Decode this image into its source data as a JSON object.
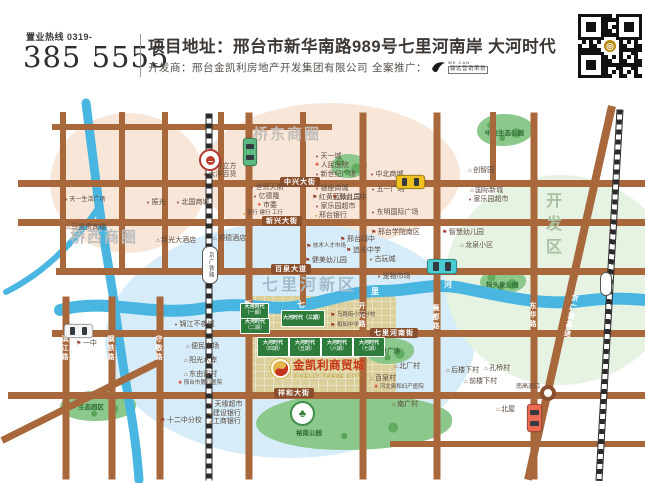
{
  "header": {
    "hotline_label": "置业热线 0319-",
    "phone": "385 5555",
    "address": "项目地址：邢台市新华南路989号七里河南岸 大河时代",
    "developer": "开发商：邢台金凯利房地产开发集团有限公司",
    "promo_label": "全案推广：",
    "promo_brand_line1": "WE CAN",
    "promo_brand_line2": "骏远营销策划"
  },
  "project": {
    "logo_title": "金凯利商贸城",
    "logo_sub": "J-KELLY TRADE CITY",
    "brand_color": "#c63420",
    "gold_color": "#c09a27",
    "area": {
      "x": 246,
      "y": 296,
      "w": 150,
      "h": 97
    },
    "logo_circle": {
      "x": 270,
      "y": 358,
      "d": 21
    },
    "title_pos": {
      "x": 293,
      "y": 361
    },
    "sub_pos": {
      "x": 294,
      "y": 375
    }
  },
  "map": {
    "zones": [
      {
        "name": "qiaoxi-circle",
        "x": 50,
        "y": 113,
        "w": 156,
        "h": 140,
        "color": "#f8e7d8"
      },
      {
        "name": "qiaodong-circle",
        "x": 200,
        "y": 103,
        "w": 260,
        "h": 144,
        "color": "#f8e7d8"
      },
      {
        "name": "qilihe-circle",
        "x": 105,
        "y": 222,
        "w": 370,
        "h": 236,
        "color": "#d6ecf8"
      },
      {
        "name": "kaifaqu-circle",
        "x": 445,
        "y": 175,
        "w": 230,
        "h": 210,
        "color": "#e6f3e2"
      }
    ],
    "zone_labels": [
      {
        "text": "桥西商圈",
        "x": 70,
        "y": 230,
        "size": 15,
        "color": "#bdbdbd",
        "ls": 2
      },
      {
        "text": "桥东商圈",
        "x": 253,
        "y": 127,
        "size": 15,
        "color": "#c4beb8",
        "ls": 2
      },
      {
        "text": "七里河新区",
        "x": 262,
        "y": 278,
        "size": 16,
        "color": "#a3bccb",
        "ls": 3
      },
      {
        "text": "开发区",
        "x": 543,
        "y": 192,
        "size": 16,
        "color": "#a9bfa0",
        "ls": 7,
        "vertical": true
      }
    ],
    "rivers": [
      {
        "d": "M 86 103 C 92 150 95 175 99 205 C 103 235 108 262 113 295 C 118 330 121 355 128 395 C 133 425 137 450 139 480",
        "w": 9
      },
      {
        "d": "M 99 207 C 82 232 58 258 34 275 C 24 282 14 288 6 292",
        "w": 6
      },
      {
        "d": "M 60 310 C 110 297 150 318 205 308 C 245 300 268 312 300 306 C 332 300 352 291 382 291 C 412 291 432 282 462 288 C 502 296 542 306 582 301 C 612 297 632 299 645 300",
        "w": 12
      }
    ],
    "river_color": "#49b6e2",
    "river_chars": [
      {
        "text": "七",
        "x": 297,
        "y": 301
      },
      {
        "text": "里",
        "x": 371,
        "y": 288
      },
      {
        "text": "河",
        "x": 444,
        "y": 281
      }
    ],
    "roads": [
      {
        "x1": 52,
        "y1": 127,
        "x2": 332,
        "y2": 127,
        "w": 6
      },
      {
        "x1": 18,
        "y1": 183,
        "x2": 645,
        "y2": 183,
        "w": 7
      },
      {
        "x1": 18,
        "y1": 222,
        "x2": 645,
        "y2": 222,
        "w": 7
      },
      {
        "x1": 56,
        "y1": 271,
        "x2": 645,
        "y2": 271,
        "w": 7
      },
      {
        "x1": 52,
        "y1": 333,
        "x2": 645,
        "y2": 333,
        "w": 7
      },
      {
        "x1": 8,
        "y1": 395,
        "x2": 645,
        "y2": 395,
        "w": 7
      },
      {
        "x1": 390,
        "y1": 444,
        "x2": 645,
        "y2": 444,
        "w": 6
      },
      {
        "x1": 63,
        "y1": 112,
        "x2": 63,
        "y2": 273,
        "w": 6
      },
      {
        "x1": 122,
        "y1": 112,
        "x2": 122,
        "y2": 273,
        "w": 6
      },
      {
        "x1": 165,
        "y1": 112,
        "x2": 165,
        "y2": 273,
        "w": 6
      },
      {
        "x1": 221,
        "y1": 112,
        "x2": 221,
        "y2": 273,
        "w": 6
      },
      {
        "x1": 66,
        "y1": 296,
        "x2": 66,
        "y2": 479,
        "w": 7
      },
      {
        "x1": 112,
        "y1": 296,
        "x2": 112,
        "y2": 479,
        "w": 7
      },
      {
        "x1": 160,
        "y1": 296,
        "x2": 160,
        "y2": 479,
        "w": 7
      },
      {
        "x1": 249,
        "y1": 112,
        "x2": 249,
        "y2": 479,
        "w": 7
      },
      {
        "x1": 303,
        "y1": 112,
        "x2": 303,
        "y2": 305,
        "w": 6
      },
      {
        "x1": 363,
        "y1": 112,
        "x2": 363,
        "y2": 479,
        "w": 7
      },
      {
        "x1": 437,
        "y1": 112,
        "x2": 437,
        "y2": 479,
        "w": 7
      },
      {
        "x1": 493,
        "y1": 112,
        "x2": 493,
        "y2": 186,
        "w": 6
      },
      {
        "x1": 534,
        "y1": 112,
        "x2": 534,
        "y2": 479,
        "w": 7
      },
      {
        "x1": 612,
        "y1": 106,
        "x2": 528,
        "y2": 480,
        "w": 8
      },
      {
        "x1": 2,
        "y1": 440,
        "x2": 162,
        "y2": 360,
        "w": 7
      }
    ],
    "railways": [
      {
        "x1": 209,
        "y1": 112,
        "x2": 209,
        "y2": 479,
        "w": 5
      },
      {
        "x1": 620,
        "y1": 108,
        "x2": 599,
        "y2": 479,
        "w": 5
      }
    ],
    "banners": [
      {
        "text": "中兴大街",
        "x": 280,
        "y": 177
      },
      {
        "text": "新兴大街",
        "x": 262,
        "y": 216
      },
      {
        "text": "百泉大道",
        "x": 271,
        "y": 264
      },
      {
        "text": "七里河南街",
        "x": 370,
        "y": 328
      },
      {
        "text": "祥和大街",
        "x": 274,
        "y": 388
      }
    ],
    "vlabels": [
      {
        "text": "新华路",
        "x": 244,
        "y": 300
      },
      {
        "text": "开元路",
        "x": 358,
        "y": 302
      },
      {
        "text": "襄都路",
        "x": 432,
        "y": 304
      },
      {
        "text": "东华路",
        "x": 529,
        "y": 302
      },
      {
        "text": "滨江路",
        "x": 61,
        "y": 335
      },
      {
        "text": "钢铁路",
        "x": 107,
        "y": 335
      },
      {
        "text": "守敬路",
        "x": 155,
        "y": 335
      },
      {
        "text": "京广澳高速",
        "x": 567,
        "y": 294,
        "rot": 12
      }
    ],
    "parks": [
      {
        "x": 477,
        "y": 114,
        "w": 56,
        "h": 32,
        "label": "中央生态公园",
        "lx": 8,
        "ly": 13
      },
      {
        "x": 331,
        "y": 154,
        "w": 36,
        "h": 24,
        "label": "",
        "lx": 0,
        "ly": 0
      },
      {
        "x": 480,
        "y": 269,
        "w": 46,
        "h": 25,
        "label": "狗头泉公园",
        "lx": 6,
        "ly": 10
      },
      {
        "x": 366,
        "y": 338,
        "w": 48,
        "h": 26,
        "label": "百泉广场",
        "lx": 8,
        "ly": 7
      },
      {
        "x": 60,
        "y": 391,
        "w": 76,
        "h": 30,
        "label": "生态园区",
        "lx": 18,
        "ly": 10
      },
      {
        "x": 256,
        "y": 394,
        "w": 196,
        "h": 56,
        "label": "裕南公园",
        "lx": 40,
        "ly": 33,
        "emblem": {
          "x": 34,
          "y": 7,
          "d": 21
        }
      }
    ],
    "blocks": [
      {
        "x": 240,
        "y": 303,
        "w": 27,
        "h": 14,
        "brand": "大河时代",
        "phase": "（一期）"
      },
      {
        "x": 240,
        "y": 318,
        "w": 28,
        "h": 14,
        "brand": "大河时代",
        "phase": "（二期）"
      },
      {
        "x": 281,
        "y": 310,
        "w": 42,
        "h": 15,
        "brand": "大河时代",
        "phase": "（三期）",
        "oneline": true
      },
      {
        "x": 257,
        "y": 337,
        "w": 30,
        "h": 18,
        "brand": "大河时代",
        "phase": "（四期）"
      },
      {
        "x": 289,
        "y": 337,
        "w": 30,
        "h": 18,
        "brand": "大河时代",
        "phase": "（五期）"
      },
      {
        "x": 321,
        "y": 337,
        "w": 30,
        "h": 18,
        "brand": "大河时代",
        "phase": "（六期）"
      },
      {
        "x": 353,
        "y": 337,
        "w": 30,
        "h": 18,
        "brand": "大河时代",
        "phase": "（七期）"
      }
    ],
    "pois": [
      {
        "icon": "mall",
        "text": "壹号立方",
        "x": 203,
        "y": 163
      },
      {
        "icon": "mall",
        "text": "大洋百货",
        "x": 203,
        "y": 171
      },
      {
        "icon": "mall",
        "text": "天一生活广场",
        "x": 64,
        "y": 197,
        "size": "sm"
      },
      {
        "icon": "mall",
        "text": "振光",
        "x": 146,
        "y": 199
      },
      {
        "icon": "mall",
        "text": "北国商城",
        "x": 176,
        "y": 199
      },
      {
        "icon": "hotel",
        "text": "马凯贵宾楼",
        "x": 66,
        "y": 224
      },
      {
        "icon": "hotel",
        "text": "新光大酒店",
        "x": 156,
        "y": 237
      },
      {
        "icon": "mall",
        "text": "世贸天街",
        "x": 250,
        "y": 184
      },
      {
        "icon": "mall",
        "text": "亿德隆",
        "x": 253,
        "y": 193
      },
      {
        "icon": "gov",
        "text": "市委",
        "x": 257,
        "y": 202
      },
      {
        "icon": "bank",
        "text": "农行 建行 工行",
        "x": 243,
        "y": 211,
        "size": "xs"
      },
      {
        "icon": "hotel",
        "text": "顺德酒店",
        "x": 213,
        "y": 235
      },
      {
        "icon": "mall",
        "text": "天一城",
        "x": 315,
        "y": 153
      },
      {
        "icon": "hospital",
        "text": "人民医院",
        "x": 315,
        "y": 162
      },
      {
        "icon": "mall",
        "text": "新世纪广场",
        "x": 315,
        "y": 171
      },
      {
        "icon": "mall",
        "text": "中北商城",
        "x": 370,
        "y": 171
      },
      {
        "icon": "mall",
        "text": "银座商城",
        "x": 315,
        "y": 185
      },
      {
        "icon": "school",
        "text": "红黄蓝幼儿园",
        "x": 312,
        "y": 194
      },
      {
        "icon": "mall",
        "text": "家乐园超市",
        "x": 315,
        "y": 203
      },
      {
        "icon": "bank",
        "text": "邢台银行",
        "x": 315,
        "y": 212
      },
      {
        "icon": "school",
        "text": "邢台四中",
        "x": 340,
        "y": 236
      },
      {
        "icon": "school",
        "text": "追光中学",
        "x": 346,
        "y": 247
      },
      {
        "icon": "school",
        "text": "技术人才市场",
        "x": 306,
        "y": 244,
        "size": "xs"
      },
      {
        "icon": "school",
        "text": "健美幼儿园",
        "x": 305,
        "y": 257
      },
      {
        "icon": "village",
        "text": "创智园",
        "x": 468,
        "y": 167
      },
      {
        "icon": "mall",
        "text": "五一广场",
        "x": 371,
        "y": 186
      },
      {
        "icon": "school",
        "text": "邢台二中",
        "x": 332,
        "y": 194
      },
      {
        "icon": "village",
        "text": "国际新城",
        "x": 470,
        "y": 187
      },
      {
        "icon": "mall",
        "text": "家乐园超市",
        "x": 468,
        "y": 196
      },
      {
        "icon": "mall",
        "text": "东明国际广场",
        "x": 371,
        "y": 209
      },
      {
        "icon": "school",
        "text": "邢台学院南区",
        "x": 371,
        "y": 229
      },
      {
        "icon": "school",
        "text": "智慧幼儿园",
        "x": 442,
        "y": 229
      },
      {
        "icon": "village",
        "text": "龙泉小区",
        "x": 460,
        "y": 242
      },
      {
        "icon": "mall",
        "text": "古玩城",
        "x": 369,
        "y": 256
      },
      {
        "icon": "mall",
        "text": "宠物市场",
        "x": 377,
        "y": 273
      },
      {
        "icon": "school",
        "text": "马路街小学分校",
        "x": 330,
        "y": 313,
        "size": "xs"
      },
      {
        "icon": "school",
        "text": "相如中学",
        "x": 330,
        "y": 323,
        "size": "xs"
      },
      {
        "icon": "mall",
        "text": "锦江不夜城",
        "x": 174,
        "y": 321
      },
      {
        "icon": "village",
        "text": "便民市场",
        "x": 186,
        "y": 343
      },
      {
        "icon": "village",
        "text": "阳光水岸",
        "x": 184,
        "y": 357
      },
      {
        "icon": "village",
        "text": "东由留村",
        "x": 184,
        "y": 371
      },
      {
        "icon": "hospital",
        "text": "邢台市第四医院",
        "x": 178,
        "y": 381,
        "size": "xs"
      },
      {
        "icon": "mall",
        "text": "天缘超市",
        "x": 209,
        "y": 401
      },
      {
        "icon": "bank",
        "text": "建设银行",
        "x": 209,
        "y": 410
      },
      {
        "icon": "bank",
        "text": "工商银行",
        "x": 209,
        "y": 418
      },
      {
        "icon": "school",
        "text": "十二中分校",
        "x": 160,
        "y": 417
      },
      {
        "icon": "school",
        "text": "一中",
        "x": 76,
        "y": 340
      },
      {
        "icon": "village",
        "text": "北厂村",
        "x": 394,
        "y": 363
      },
      {
        "icon": "village",
        "text": "百泉村",
        "x": 370,
        "y": 375
      },
      {
        "icon": "hospital",
        "text": "河北奥和妇产医院",
        "x": 374,
        "y": 385,
        "size": "xs"
      },
      {
        "icon": "village",
        "text": "南广村",
        "x": 392,
        "y": 401
      },
      {
        "icon": "village",
        "text": "后楼下村",
        "x": 446,
        "y": 367
      },
      {
        "icon": "village",
        "text": "孔桥村",
        "x": 484,
        "y": 365
      },
      {
        "icon": "village",
        "text": "前楼下村",
        "x": 464,
        "y": 378
      },
      {
        "icon": "plain",
        "text": "南高速口",
        "x": 516,
        "y": 384,
        "size": "sm"
      },
      {
        "icon": "village",
        "text": "北屋",
        "x": 496,
        "y": 406
      }
    ],
    "cars": [
      {
        "x": 243,
        "y": 138,
        "w": 12,
        "h": 26,
        "color": "#5cb87f",
        "dir": "v",
        "name": "car-green"
      },
      {
        "x": 396,
        "y": 175,
        "w": 27,
        "h": 12,
        "color": "#f0c11f",
        "dir": "h",
        "name": "car-yellow"
      },
      {
        "x": 427,
        "y": 259,
        "w": 28,
        "h": 13,
        "color": "#49ccd2",
        "dir": "h",
        "name": "car-teal"
      },
      {
        "x": 64,
        "y": 324,
        "w": 27,
        "h": 12,
        "color": "#f5f5f5",
        "dir": "h",
        "name": "car-white"
      },
      {
        "x": 527,
        "y": 404,
        "w": 13,
        "h": 26,
        "color": "#ec6a52",
        "dir": "v",
        "name": "car-red"
      }
    ],
    "station_circle": {
      "x": 199,
      "y": 149,
      "d": 22
    },
    "station_oval": {
      "x": 202,
      "y": 246,
      "w": 14,
      "h": 36,
      "label": "京广铁路"
    },
    "train": {
      "x": 600,
      "y": 272,
      "w": 10,
      "h": 22
    },
    "interchange": {
      "x": 540,
      "y": 385,
      "d": 16
    }
  }
}
